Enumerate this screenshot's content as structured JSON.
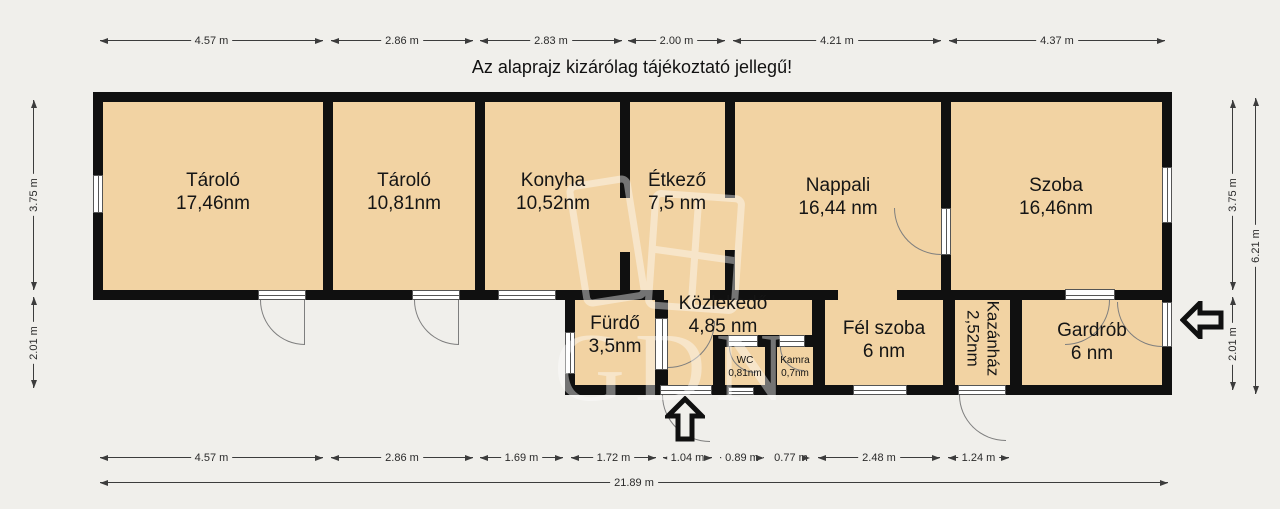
{
  "title": "Az alaprajz kizárólag tájékoztató jellegű!",
  "watermark": {
    "text": "GDN"
  },
  "rooms": [
    {
      "name": "Tároló",
      "area": "17,46nm"
    },
    {
      "name": "Tároló",
      "area": "10,81nm"
    },
    {
      "name": "Konyha",
      "area": "10,52nm"
    },
    {
      "name": "Étkező",
      "area": "7,5 nm"
    },
    {
      "name": "Nappali",
      "area": "16,44 nm"
    },
    {
      "name": "Szoba",
      "area": "16,46nm"
    },
    {
      "name": "Fürdő",
      "area": "3,5nm"
    },
    {
      "name": "Közlekedő",
      "area": "4,85 nm"
    },
    {
      "name": "WC",
      "area": "0,81nm"
    },
    {
      "name": "Kamra",
      "area": "0,7nm"
    },
    {
      "name": "Fél szoba",
      "area": "6 nm"
    },
    {
      "name": "Kazánház",
      "area": "2,52nm"
    },
    {
      "name": "Gardrób",
      "area": "6 nm"
    }
  ],
  "dims": {
    "top": [
      "4.57 m",
      "2.86 m",
      "2.83 m",
      "2.00 m",
      "4.21 m",
      "4.37 m"
    ],
    "bottom": [
      "4.57 m",
      "2.86 m",
      "1.69 m",
      "1.72 m",
      "1.04 m",
      "0.89 m",
      "0.77 m",
      "2.48 m",
      "1.24 m"
    ],
    "total_width": "21.89 m",
    "left": [
      "3.75 m",
      "2.01 m"
    ],
    "right": [
      "3.75 m",
      "2.01 m"
    ],
    "total_height": "6.21 m"
  },
  "icons": {
    "entrance_bottom": "arrow-up-entrance",
    "entrance_right": "arrow-left-entrance"
  },
  "colors": {
    "background": "#f0efeb",
    "wall": "#101010",
    "room_fill": "#f2d3a3",
    "dimension": "#3c3c3c"
  }
}
